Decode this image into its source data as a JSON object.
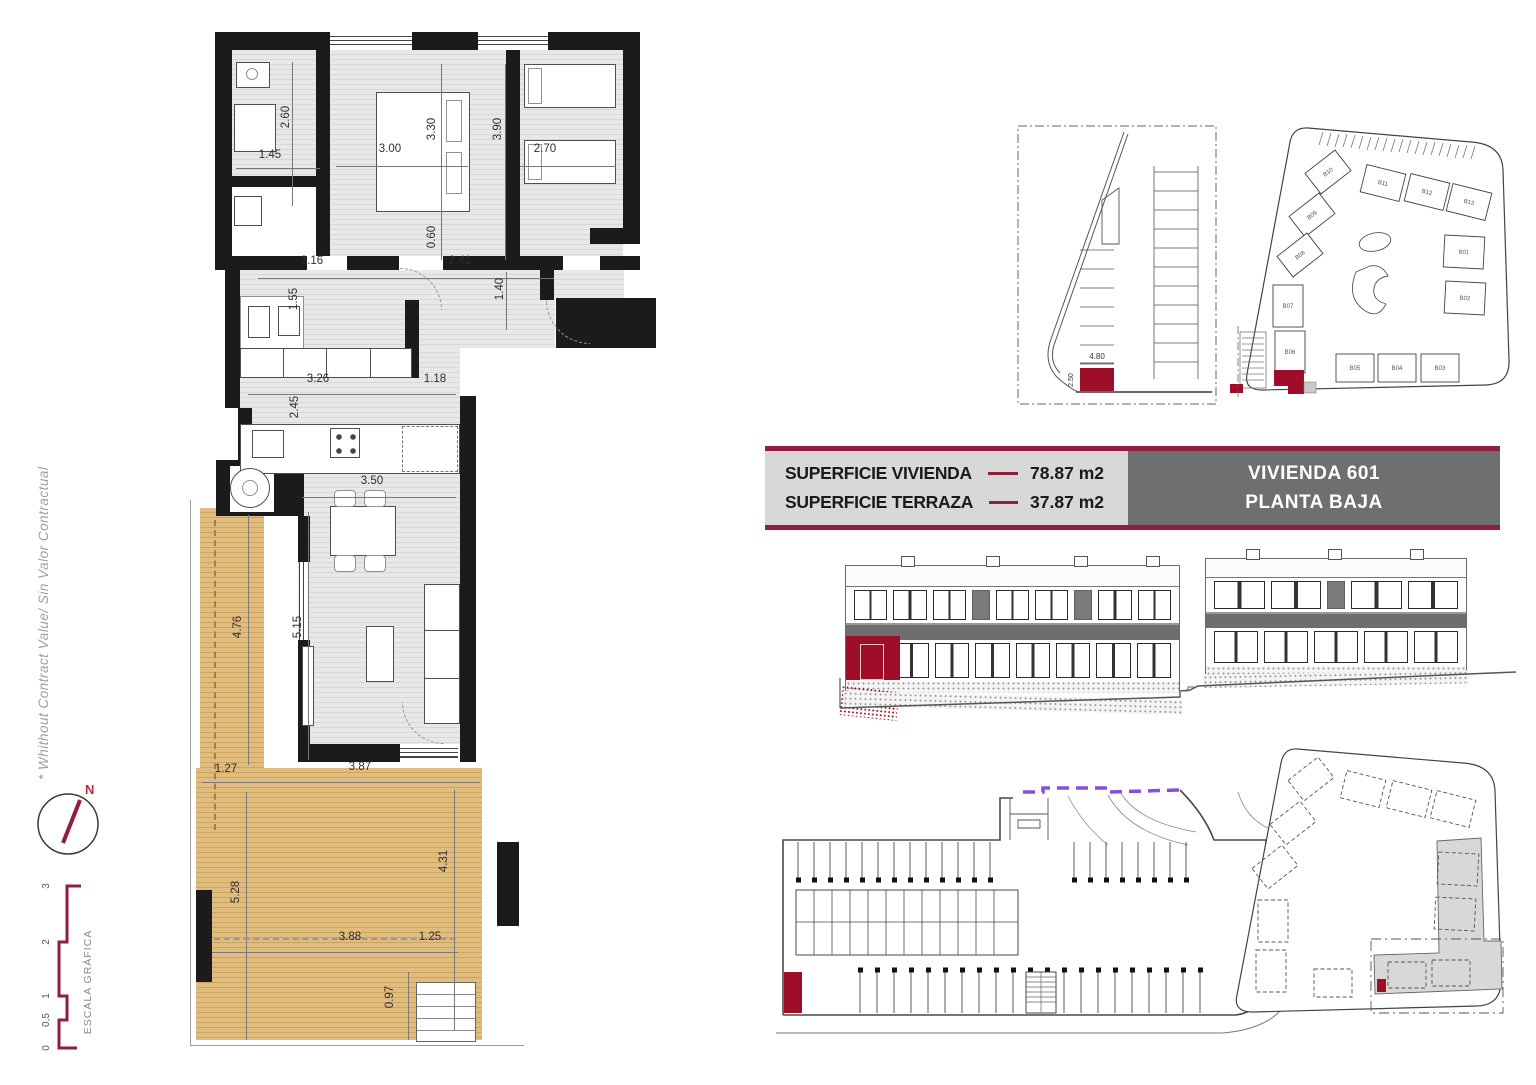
{
  "sheet": {
    "disclaimer": "* Whithout Contract Value/ Sin Valor Contractual",
    "compass": {
      "label": "N"
    },
    "scale_bar": {
      "title": "ESCALA GRÁFICA",
      "ticks": [
        "0",
        "0,5",
        "1",
        "2",
        "3"
      ]
    }
  },
  "banner": {
    "rows": [
      {
        "label": "SUPERFICIE VIVIENDA",
        "value": "78.87 m2"
      },
      {
        "label": "SUPERFICIE TERRAZA",
        "value": "37.87 m2"
      }
    ],
    "unit_line1": "VIVIENDA 601",
    "unit_line2": "PLANTA BAJA",
    "colors": {
      "accent": "#8e1f3d",
      "panel_bg": "#d8d8d8",
      "unit_bg": "#6e6f71",
      "highlight_red": "#9e0e28",
      "terrace_wood": "#ddb878",
      "ramp_purple": "#8a4fd8"
    }
  },
  "floorplan": {
    "dims": [
      "2.60",
      "1.45",
      "3.00",
      "3.30",
      "3.90",
      "2.70",
      "0.60",
      "3.16",
      "2.41",
      "1.55",
      "1.40",
      "3.26",
      "1.18",
      "2.45",
      "3.50",
      "4.76",
      "5.15",
      "1.27",
      "3.87",
      "5.28",
      "4.31",
      "3.88",
      "1.25",
      "0.97"
    ]
  },
  "parking_plan": {
    "width_dim": "4.80",
    "depth_dim": "2.50"
  },
  "site_plan": {
    "units": [
      "B10",
      "B11",
      "B12",
      "B13",
      "B09",
      "B08",
      "B07",
      "B06",
      "B05",
      "B04",
      "B03",
      "B01",
      "B02"
    ]
  }
}
